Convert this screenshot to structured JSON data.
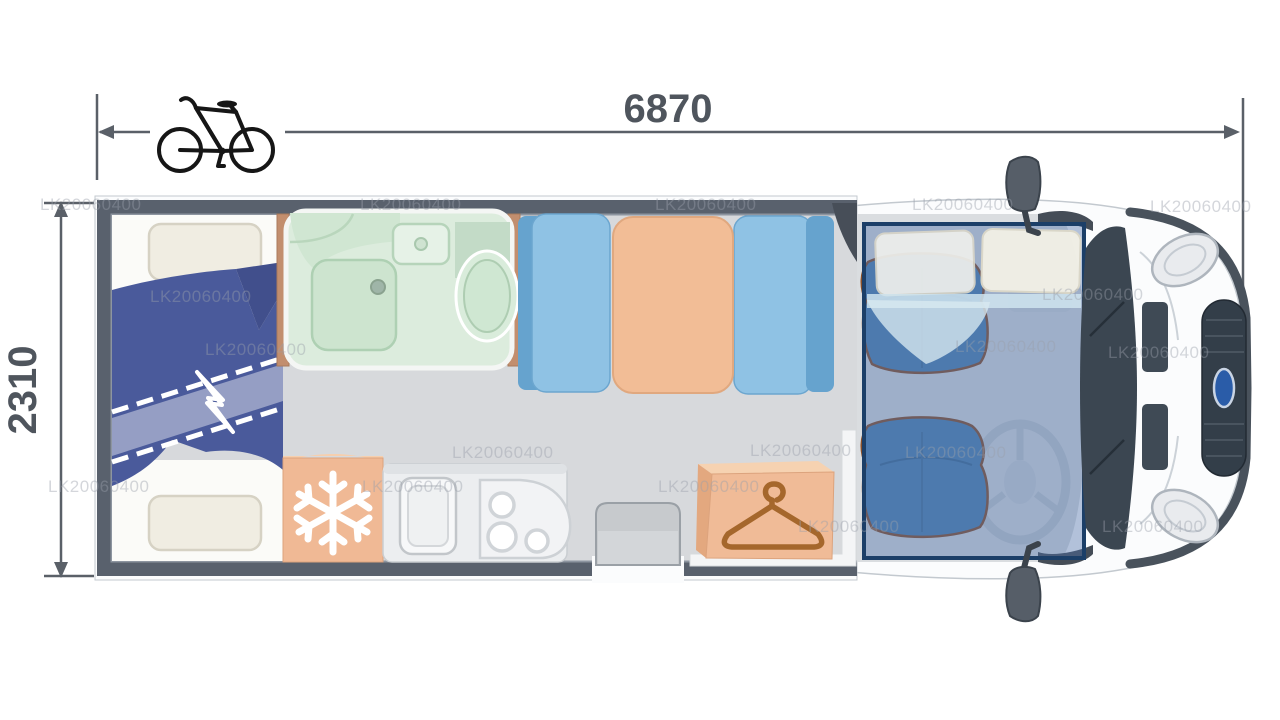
{
  "page": {
    "type": "motorhome-floorplan-diagram",
    "background": "#ffffff"
  },
  "dimensions": {
    "length": "6870",
    "width": "2310"
  },
  "watermark": {
    "text": "LK20060400"
  },
  "icons": [
    "bicycle-icon",
    "snowflake-icon",
    "clothes-hanger-icon",
    "bed-extension-break-icon",
    "steering-wheel-icon",
    "ford-logo-icon"
  ],
  "colors": {
    "dimension_text": "#4f555d",
    "dimension_line": "#5a6068",
    "wall": "#59616d",
    "floor": "#d7d9dc",
    "duvet_navy": "#4a5a9b",
    "duvet_band": "#99a2c6",
    "pillow": "#f0ede2",
    "bathroom_mint": "#dcecdd",
    "wood_trim": "#c28e6e",
    "bench_seat": "#8fc2e4",
    "bench_backrest": "#66a3ce",
    "table_peach": "#f2bd96",
    "cabinet_peach": "#f0b995",
    "hanger_brown": "#a5672c",
    "cab_seat_blue": "#4f82b1",
    "cab_seat_outline": "#8a4f28",
    "overcab_bed_overlay": "#4d70aa",
    "overlay_border": "#1c3f68",
    "vehicle_dark_trim": "#49525c",
    "windshield": "#3b4651",
    "ford_blue": "#2a5ca8"
  }
}
